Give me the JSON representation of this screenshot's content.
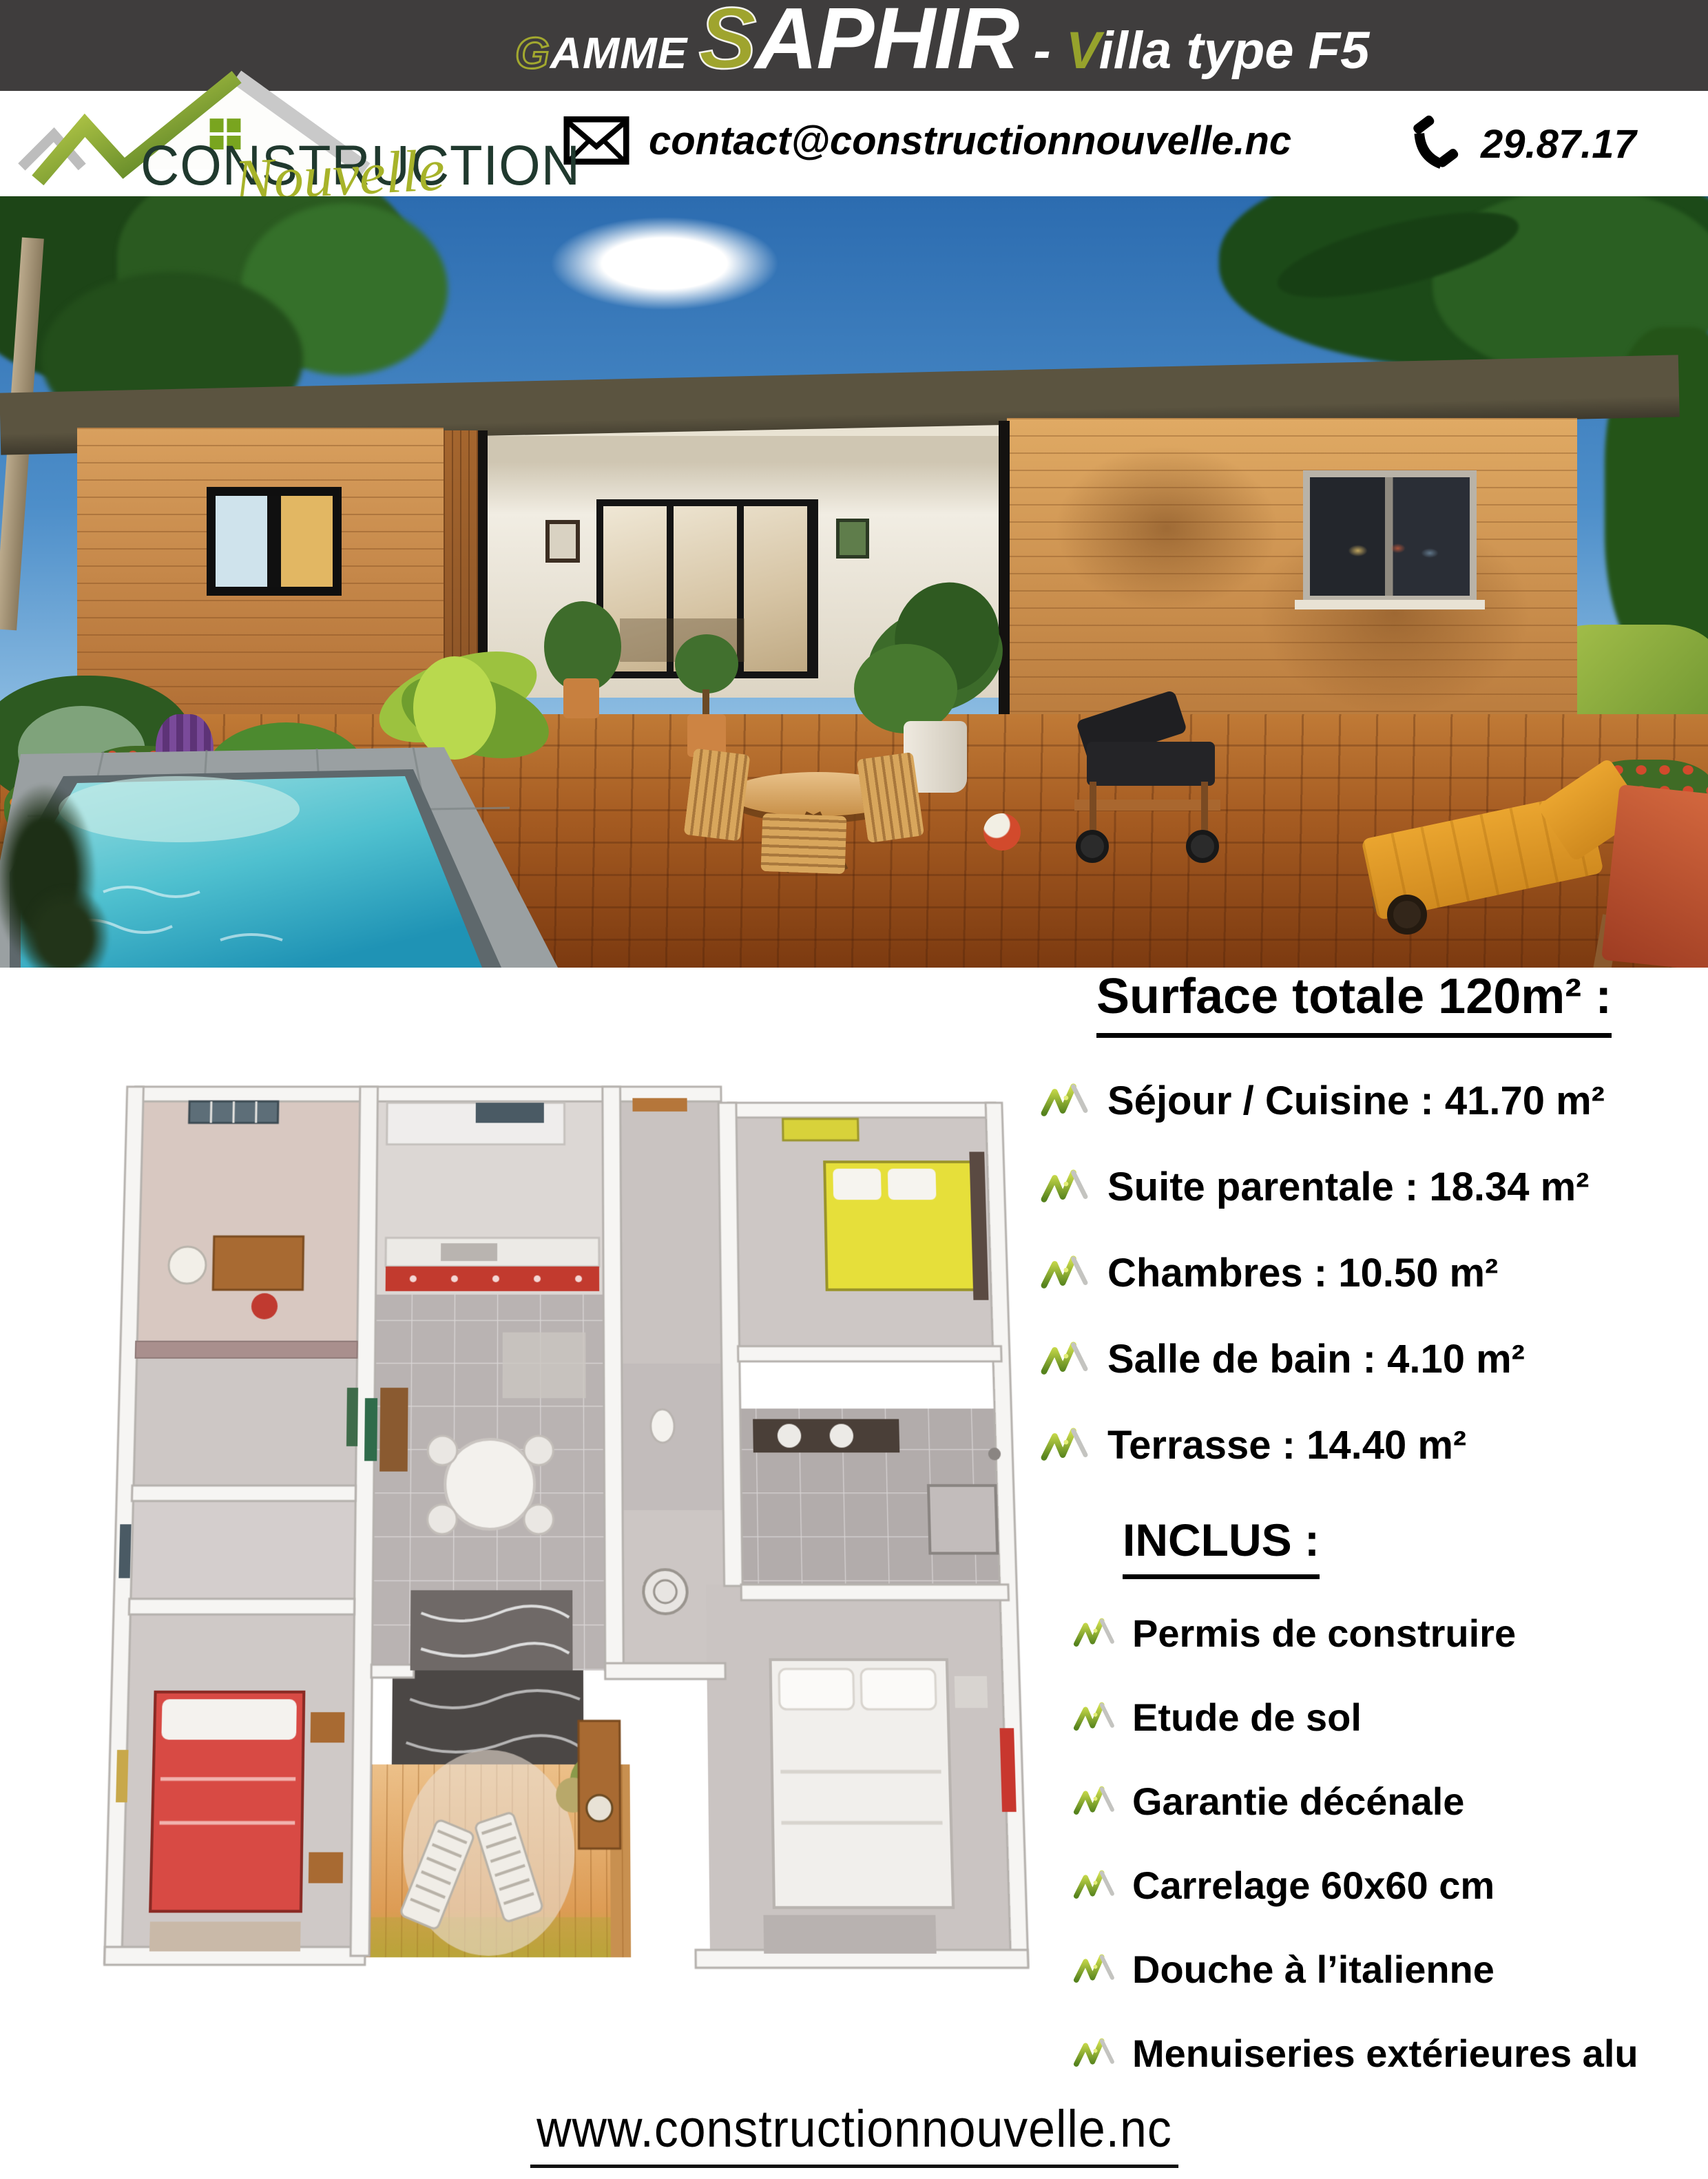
{
  "brand": {
    "name_caps": "CONSTRUCTION",
    "name_script": "Nouvelle"
  },
  "header": {
    "bg_color": "#3f3d3d",
    "accent_green": "#a2a82f",
    "gamme_initial": "G",
    "gamme_rest": "AMME",
    "range_initial": "S",
    "range_rest": "APHIR",
    "separator": "-",
    "villa_initial": "V",
    "villa_rest": "illa type F5"
  },
  "contact": {
    "email": "contact@constructionnouvelle.nc",
    "phone": "29.87.17",
    "email_icon": "envelope-icon",
    "phone_icon": "phone-icon"
  },
  "surface": {
    "title": "Surface totale 120m² :",
    "bullet_icon": "green-check-icon",
    "items": [
      "Séjour / Cuisine : 41.70 m²",
      "Suite parentale : 18.34 m²",
      "Chambres : 10.50 m²",
      "Salle de bain : 4.10 m²",
      "Terrasse : 14.40 m²"
    ]
  },
  "inclus": {
    "title": "INCLUS :",
    "bullet_icon": "green-check-icon",
    "items": [
      "Permis de construire",
      "Etude de sol",
      "Garantie décénale",
      "Carrelage 60x60 cm",
      "Douche à l’italienne",
      "Menuiseries extérieures alu"
    ]
  },
  "footer": {
    "website": "www.constructionnouvelle.nc"
  },
  "colors": {
    "logo_dark_green": "#20392e",
    "logo_olive": "#a7b32a",
    "check_green": "#55821d",
    "roof": "#5b5440",
    "wood_siding": "#c98c4e",
    "pool_water": "#2d9fba"
  }
}
